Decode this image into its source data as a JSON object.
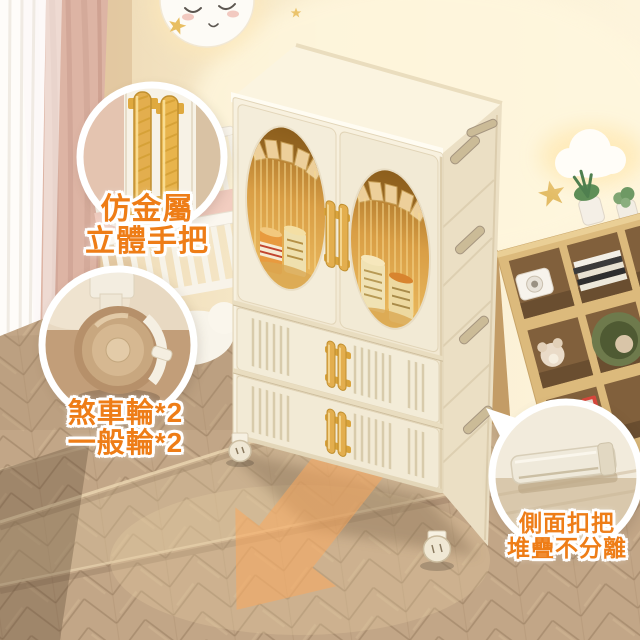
{
  "product_annotations": {
    "handle_callout": {
      "line1": "仿金屬",
      "line2": "立體手把"
    },
    "wheel_callout": {
      "line1": "煞車輪*2",
      "line2": "一般輪*2"
    },
    "buckle_callout": {
      "line1": "側面扣把",
      "line2": "堆疊不分離"
    }
  },
  "colors": {
    "label_orange": "#EE7D17",
    "arrow_orange_start": "#F9A85E",
    "arrow_orange_end": "#F2701E",
    "cabinet_body": "#F2EAD6",
    "cabinet_side": "#EBDFC4",
    "cabinet_top": "#FBF4E0",
    "gold_handle": "#E3AE4E",
    "window_amber_dark": "#9C6921",
    "window_amber_light": "#EDBE63",
    "wall_left": "#EAD3AC",
    "wall_right": "#FDF4DC",
    "floor_wood": "#C2A687",
    "shelf_wood": "#DCBA7C",
    "curtain_pink": "#DDB4A4"
  }
}
